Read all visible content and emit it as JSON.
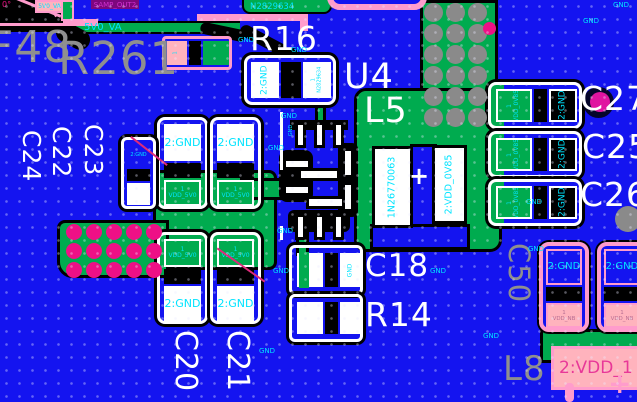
{
  "pcb": {
    "colors": {
      "board_blue": "#1414f0",
      "copper_green": "#00ab4f",
      "outline_pink": "#ff9ccc",
      "pad_salmon": "#ffb3bd",
      "via_magenta": "#ee1086",
      "silk_white": "#ffffff",
      "text_gray": "#8f8f8f",
      "net_cyan": "#00e4ff",
      "purple": "#7d077d",
      "purple_text": "#cf2fcf"
    },
    "texts": {
      "f48": "F48",
      "r261": "R261",
      "r16": "R16",
      "u4": "U4",
      "l5": "L5",
      "c18": "C18",
      "r14": "R14",
      "c20": "C20",
      "c21": "C21",
      "c22": "C22",
      "c23": "C23",
      "c24": "C24",
      "c25": "C25",
      "c26": "C26",
      "c27": "C27",
      "c50": "C50",
      "l8": "L8",
      "samp_out2": "SAMP_OUT2",
      "v5_va": "5V0_VA",
      "n2829634": "N2829634",
      "deg0": "0°",
      "plus": "+",
      "pad1": "1",
      "gnd": "GND",
      "gnd2": "2:GND",
      "vdd_5v0": "VDD_5V0",
      "vdd_0v85": "VDD_0V85",
      "vdd_nb": "VDD_NB",
      "l5_pad1": "1N26770063",
      "l5_pad2": "2:VDD_0V85",
      "vdd_1": "2:VDD_1"
    },
    "gnd_labels": [
      {
        "x": 238,
        "y": 37
      },
      {
        "x": 291,
        "y": 47
      },
      {
        "x": 281,
        "y": 113
      },
      {
        "x": 268,
        "y": 145
      },
      {
        "x": 277,
        "y": 228
      },
      {
        "x": 273,
        "y": 268
      },
      {
        "x": 430,
        "y": 268
      },
      {
        "x": 259,
        "y": 348
      },
      {
        "x": 483,
        "y": 333
      },
      {
        "x": 613,
        "y": 2
      },
      {
        "x": 583,
        "y": 18
      },
      {
        "x": 526,
        "y": 199
      },
      {
        "x": 528,
        "y": 246
      }
    ],
    "via_grids": [
      {
        "name": "gnd-via-grid",
        "x0": 424,
        "y0": 3,
        "cols": 3,
        "rows": 6,
        "dx": 22,
        "dy": 21,
        "d": 19,
        "color": "#8a8a8a"
      },
      {
        "name": "pink-via-grid",
        "x0": 66,
        "y0": 224,
        "cols": 5,
        "rows": 3,
        "dx": 20,
        "dy": 19,
        "d": 16,
        "color": "#ee1086"
      }
    ],
    "single_vias": [
      {
        "name": "gray-via",
        "x": 615,
        "y": 206,
        "d": 26,
        "color": "#8a8a8a"
      },
      {
        "name": "dark-via",
        "x": 583,
        "y": 87,
        "d": 31,
        "color": "#05052a"
      },
      {
        "name": "magenta-via",
        "x": 590,
        "y": 92,
        "d": 20,
        "color": "#e014a0"
      },
      {
        "name": "magenta-via-edge",
        "x": 483,
        "y": 22,
        "d": 13,
        "color": "#ee1086"
      }
    ]
  }
}
